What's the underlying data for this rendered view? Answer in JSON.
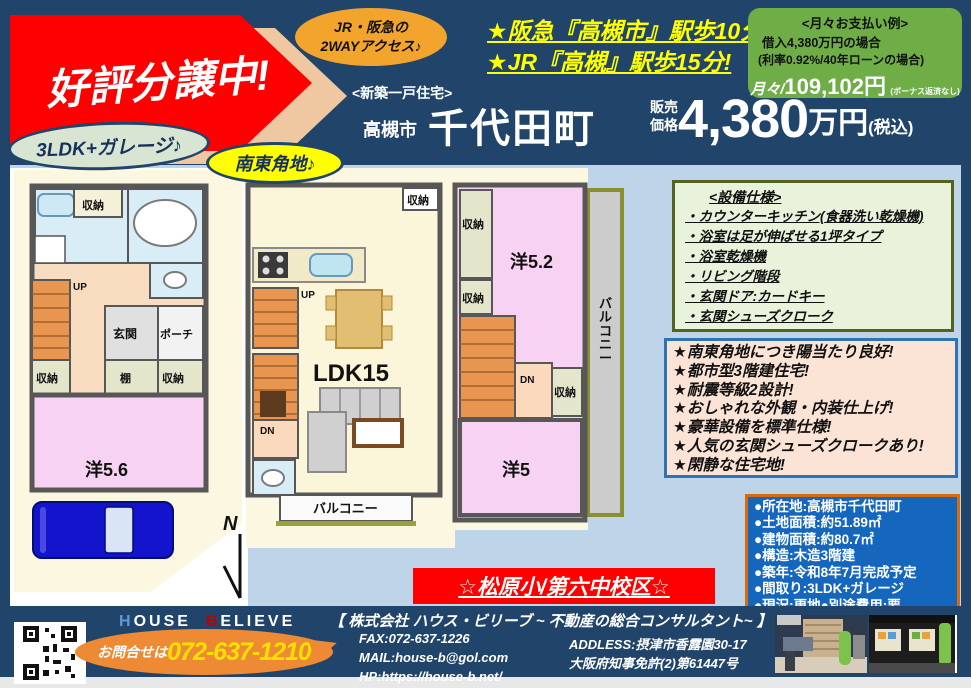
{
  "colors": {
    "header_bg": "#21456A",
    "page_bg": "#BED4E8",
    "banner_red": "#FF0000",
    "banner_tan": "#EFC7A0",
    "payment_green": "#6FAD47",
    "accent_orange": "#ED8A33",
    "phone_yellow": "#FFE000",
    "info_blue": "#1567BE",
    "info_border": "#D96B0B"
  },
  "header": {
    "sale_banner": "好評分譲中!",
    "access_bubble_line1": "JR・阪急の",
    "access_bubble_line2": "2WAYアクセス♪",
    "station_line1": "★阪急『高槻市』駅歩10分!",
    "station_line2": "★JR『高槻』駅歩15分!",
    "payment": {
      "title": "<月々お支払い例>",
      "line1": "借入4,380万円の場合",
      "line2": "(利率0.92%/40年ローンの場合)",
      "prefix": "月々/",
      "amount": "109,102円",
      "note": "(ボーナス返済なし)"
    },
    "property_type": "<新築一戸住宅>",
    "city": "高槻市",
    "town": "千代田町",
    "price_label1": "販売",
    "price_label2": "価格",
    "price_value": "4,380",
    "price_unit": "万円",
    "price_tax": "(税込)",
    "bubble_3ldk": "3LDK+ガレージ♪",
    "bubble_corner": "南東角地♪"
  },
  "floorplan": {
    "labels": {
      "storage": "収納",
      "shelf": "棚",
      "genkan": "玄関",
      "porch": "ポーチ",
      "up": "UP",
      "dn": "DN",
      "room56": "洋5.6",
      "ldk": "LDK15",
      "balcony": "バルコニー",
      "room52": "洋5.2",
      "room5": "洋5",
      "compass": "N"
    }
  },
  "specs": {
    "title": "<設備仕様>",
    "items": [
      "・カウンターキッチン(食器洗い乾燥機)",
      "・浴室は足が伸ばせる1坪タイプ",
      "・浴室乾燥機",
      "・リビング階段",
      "・玄関ドア:カードキー",
      "・玄関シューズクローク"
    ]
  },
  "features": {
    "items": [
      "★南東角地につき陽当たり良好!",
      "★都市型3階建住宅!",
      "★耐震等級2設計!",
      "★おしゃれな外観・内装仕上げ!",
      "★豪華設備を標準仕様!",
      "★人気の玄関シューズクロークあり!",
      "★閑静な住宅地!"
    ]
  },
  "details": {
    "items": [
      "●所在地:高槻市千代田町",
      "●土地面積:約51.89㎡",
      "●建物面積:約80.7㎡",
      "●構造:木造3階建",
      "●築年:令和8年7月完成予定",
      "●間取り:3LDK+ガレージ",
      "●現況:更地●別途費用:要"
    ]
  },
  "school_banner": "☆松原小/第六中校区☆",
  "footer": {
    "brand_h": "H",
    "brand_ouse": "OUSE",
    "brand_b": "B",
    "brand_elieve": "ELIEVE",
    "company": "【 株式会社 ハウス・ビリーブ ~ 不動産の総合コンサルタント~ 】",
    "contact_prefix": "お問合せは",
    "phone": "072-637-1210",
    "fax": "FAX:072-637-1226",
    "mail": "MAIL:house-b@gol.com",
    "hp": "HP:https://house-b.net/",
    "address1": "ADDLESS:摂津市香露園30-17",
    "address2": "大阪府知事免許(2)第61447号"
  }
}
